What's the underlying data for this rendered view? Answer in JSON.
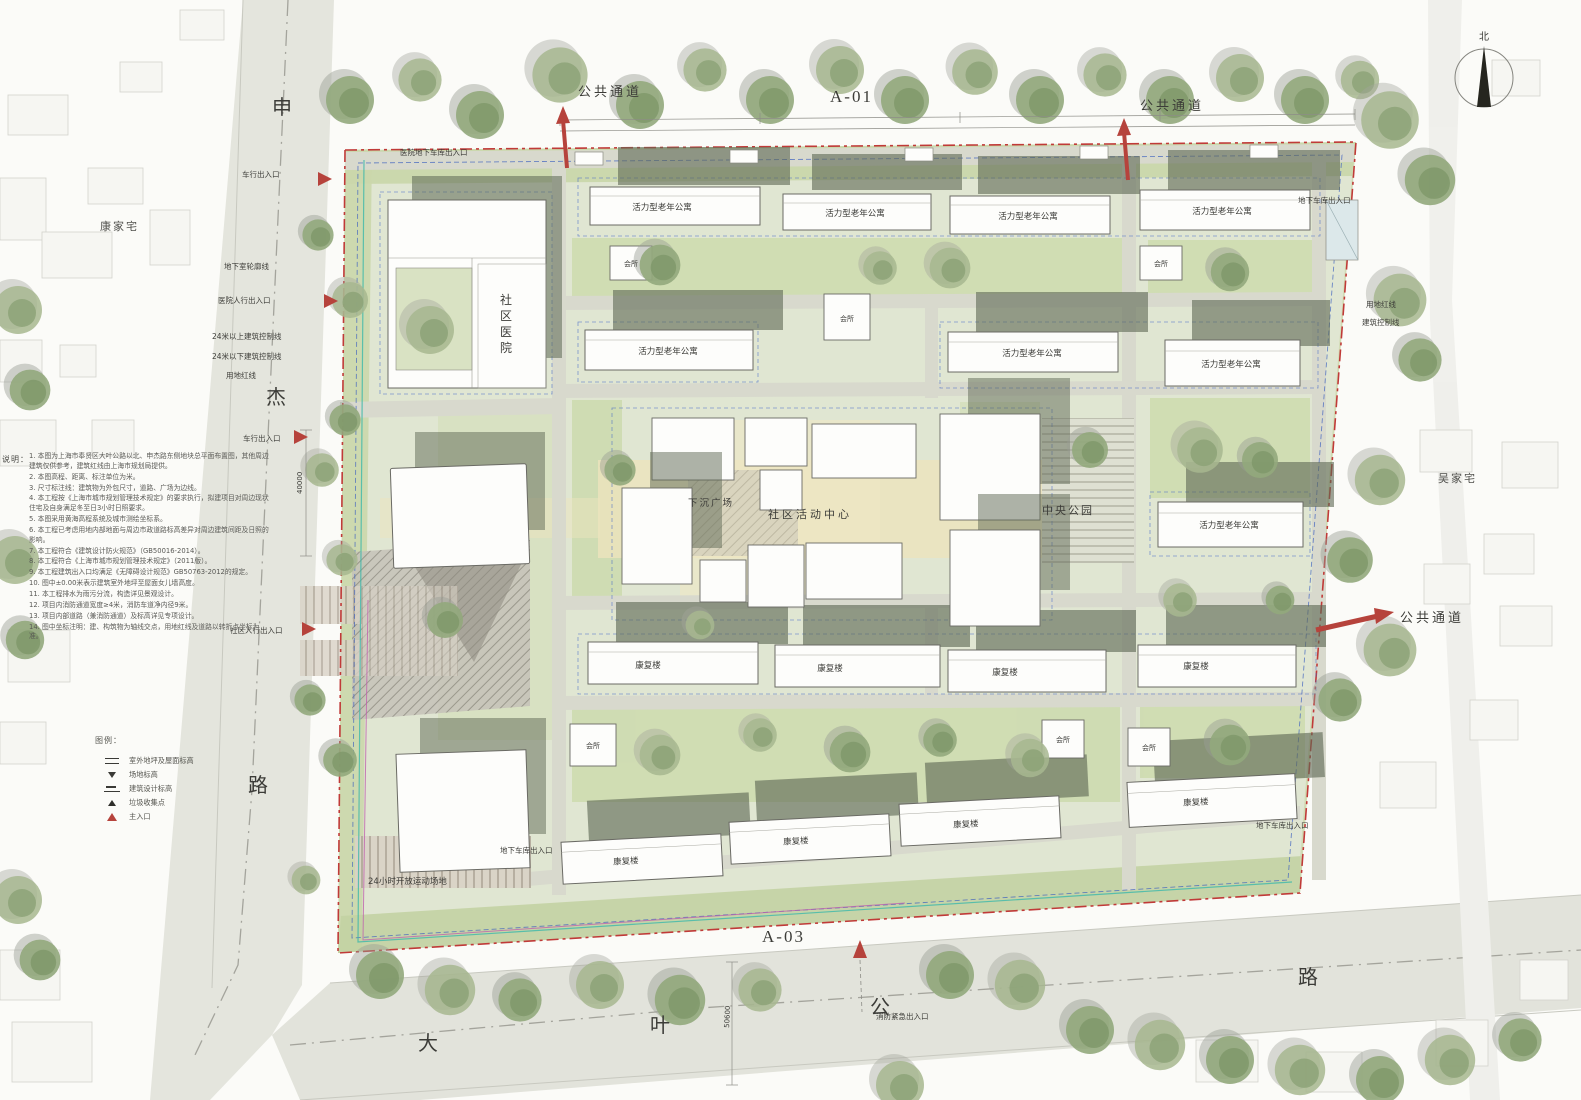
{
  "compass": {
    "north": "北"
  },
  "sectors": {
    "a01": "A-01",
    "a03": "A-03"
  },
  "roads": {
    "west": {
      "chars": [
        "申",
        "杰",
        "路"
      ]
    },
    "south": {
      "chars": [
        "大",
        "叶",
        "公",
        "路"
      ]
    }
  },
  "context": {
    "west_village": "康家宅",
    "east_village": "吴家宅"
  },
  "passage_label": "公共通道",
  "areas": {
    "hospital_chars": [
      "社",
      "区",
      "医",
      "院"
    ],
    "sunken_plaza": "下沉广场",
    "activity_center": "社区活动中心",
    "central_park": "中央公园",
    "sports_field": "24小时开放运动场地"
  },
  "buildings": {
    "senior_apartment": "活力型老年公寓",
    "rehab": "康复楼",
    "clubhouse": "会所"
  },
  "entrances": {
    "vehicle": "车行出入口",
    "hospital_pedestrian": "医院人行出入口",
    "community_pedestrian": "社区人行出入口",
    "hospital_garage": "医院地下车库出入口",
    "garage": "地下车库出入口",
    "fire_emergency": "消防紧急出入口"
  },
  "lines": {
    "basement_outline": "地下室轮廓线",
    "above_24m": "24米以上建筑控制线",
    "below_24m": "24米以下建筑控制线",
    "red_line": "用地红线",
    "control_line": "建筑控制线"
  },
  "dimensions": {
    "west_width": "40000",
    "south_width": "50600"
  },
  "notes": {
    "header": "说明：",
    "items": [
      "1. 本图为上海市奉贤区大叶公路以北、申杰路东侧地块总平面布置图，其他周边建筑仅供参考，建筑红线由上海市规划局提供。",
      "2. 本图高程、距离、标注单位为米。",
      "3. 尺寸标注线：建筑物为外包尺寸，道路、广场为边线。",
      "4. 本工程按《上海市城市规划管理技术规定》的要求执行，拟建项目对周边现状住宅及自身满足冬至日3小时日照要求。",
      "5. 本图采用黄海高程系统及城市测绘坐标系。",
      "6. 本工程已考虑用地内部地面与周边市政道路标高差异对周边建筑间距及日照的影响。",
      "7. 本工程符合《建筑设计防火规范》（GB50016-2014）。",
      "8. 本工程符合《上海市城市规划管理技术规定》（2011版）。",
      "9. 本工程建筑出入口均满足《无障碍设计规范》GB50763-2012的规定。",
      "10. 图中±0.00米表示建筑室外地坪至屋面女儿墙高度。",
      "11. 本工程排水为雨污分流，构造详见景观设计。",
      "12. 项目内消防通道宽度≥4米，消防车道净内径9米。",
      "13. 项目内部道路（兼消防通道）及标高详见专项设计。",
      "14. 图中坐标注明：建、构筑物为轴线交点，用地红线及道路以转折点坐标为准。"
    ]
  },
  "legend": {
    "header": "图例：",
    "items": [
      {
        "icon": "roof-elevation-mark",
        "label": "室外地坪及屋面标高"
      },
      {
        "icon": "site-elevation-mark",
        "label": "场地标高"
      },
      {
        "icon": "design-elevation-mark",
        "label": "建筑设计标高"
      },
      {
        "icon": "trash-collection-point",
        "label": "垃圾收集点"
      },
      {
        "icon": "main-entrance-arrow",
        "label": "主入口"
      }
    ]
  },
  "colors": {
    "site_green": "#dfe5d2",
    "boundary_red": "#c03a38",
    "control_blue": "#4063bf",
    "passage_red": "#b6433c",
    "tree_green": "#8fa678"
  }
}
